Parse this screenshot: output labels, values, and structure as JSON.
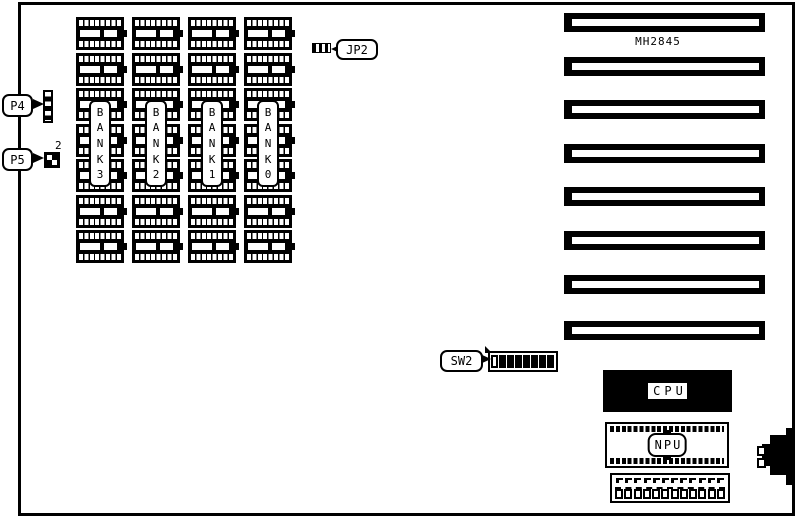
{
  "diagram": {
    "title": "MH2845",
    "ink": "#000000",
    "background": "#ffffff"
  },
  "callouts": {
    "p4": "P4",
    "p5": "P5",
    "p5_pin_count": "2",
    "jp2": "JP2",
    "sw2": "SW2"
  },
  "cpu": {
    "label": "CPU"
  },
  "npu": {
    "label": "NPU"
  },
  "memory": {
    "banks": [
      {
        "name": "BANK 3",
        "letters": [
          "B",
          "A",
          "N",
          "K",
          "3"
        ],
        "chip_count": 7
      },
      {
        "name": "BANK 2",
        "letters": [
          "B",
          "A",
          "N",
          "K",
          "2"
        ],
        "chip_count": 7
      },
      {
        "name": "BANK 1",
        "letters": [
          "B",
          "A",
          "N",
          "K",
          "1"
        ],
        "chip_count": 7
      },
      {
        "name": "BANK 0",
        "letters": [
          "B",
          "A",
          "N",
          "K",
          "0"
        ],
        "chip_count": 7
      }
    ]
  },
  "expansion_slots": {
    "count": 8
  },
  "dip_switch": {
    "positions": 8,
    "open_positions": [
      1
    ]
  },
  "power_connector": {
    "pins": 12
  }
}
